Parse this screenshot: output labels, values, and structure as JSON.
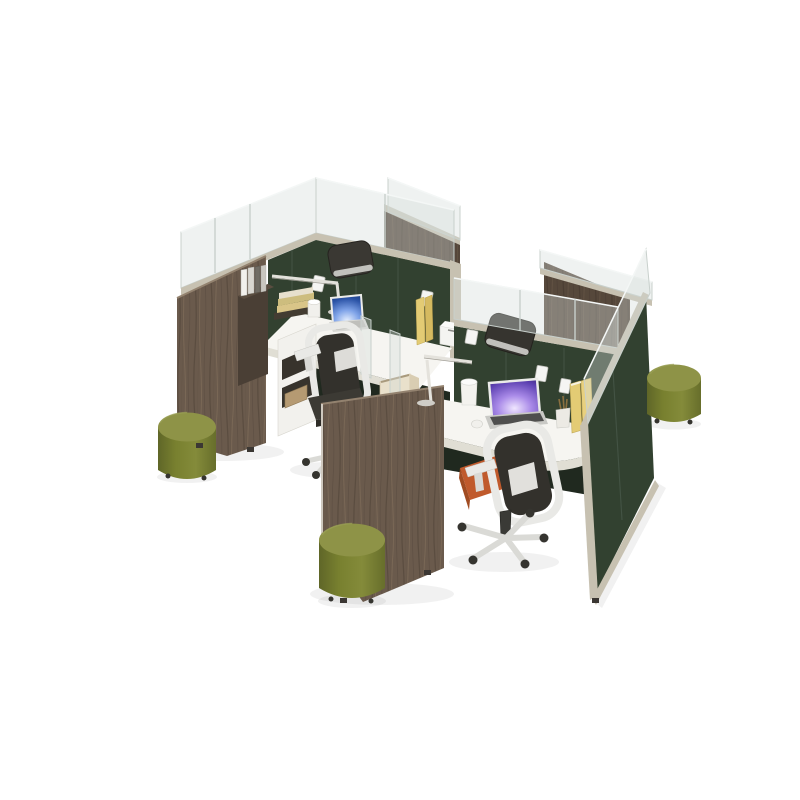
{
  "scene": {
    "type": "3d-product-render",
    "subject": "Modular four-person office cubicle workstation cluster on white background",
    "view": "isometric three-quarter aerial",
    "inventory": {
      "workstations_fully_visible": 2,
      "task_chairs_visible": 4,
      "round_ottomans": 3,
      "laptops": 2,
      "task_lamps": 2,
      "glass_panel_toppers": true,
      "fabric_panel_color_name": "dark green",
      "end_panel_material": "walnut wood veneer",
      "desk_style": "white L-shaped worksurface",
      "accessories": [
        "stacked books",
        "upright yellow books",
        "binders",
        "coffee cup",
        "mug",
        "pencil cup",
        "succulent plant",
        "planter box",
        "open white shelf",
        "power outlets",
        "computer mouse",
        "printer box"
      ]
    }
  },
  "palette": {
    "background": "#ffffff",
    "panel_green": "#324130",
    "panel_green_dark": "#283429",
    "panel_seam": "#48584a",
    "wood": "#6a5a4c",
    "wood_dark": "#4e4136",
    "frame_tan": "#c7c1b1",
    "frame_tan_dark": "#a59f90",
    "glass_fill": "rgba(213,222,219,0.38)",
    "glass_edge": "#c8d0cc",
    "glass_highlight": "#f4f7f6",
    "desk_white": "#f6f5f1",
    "desk_edge": "#e0ded4",
    "under_desk": "#20291f",
    "chair_white": "#e9e9e6",
    "chair_mesh": "#33312c",
    "seat_orange": "#c05a2c",
    "seat_orange_dark": "#a14c22",
    "ottoman_top": "#8e9347",
    "ottoman_side": "#78802f",
    "ottoman_dark": "#5f6628",
    "book_yellow": "#e3cb74",
    "book_yellow_dark": "#d5ba60",
    "book_tan": "#d9c588",
    "paper_white": "#f2f1ed",
    "plant_green": "#5d7d3e",
    "metal_gray": "#d6d6d2",
    "caster_dark": "#35342f",
    "cabinet_brown": "#4a3f35"
  }
}
